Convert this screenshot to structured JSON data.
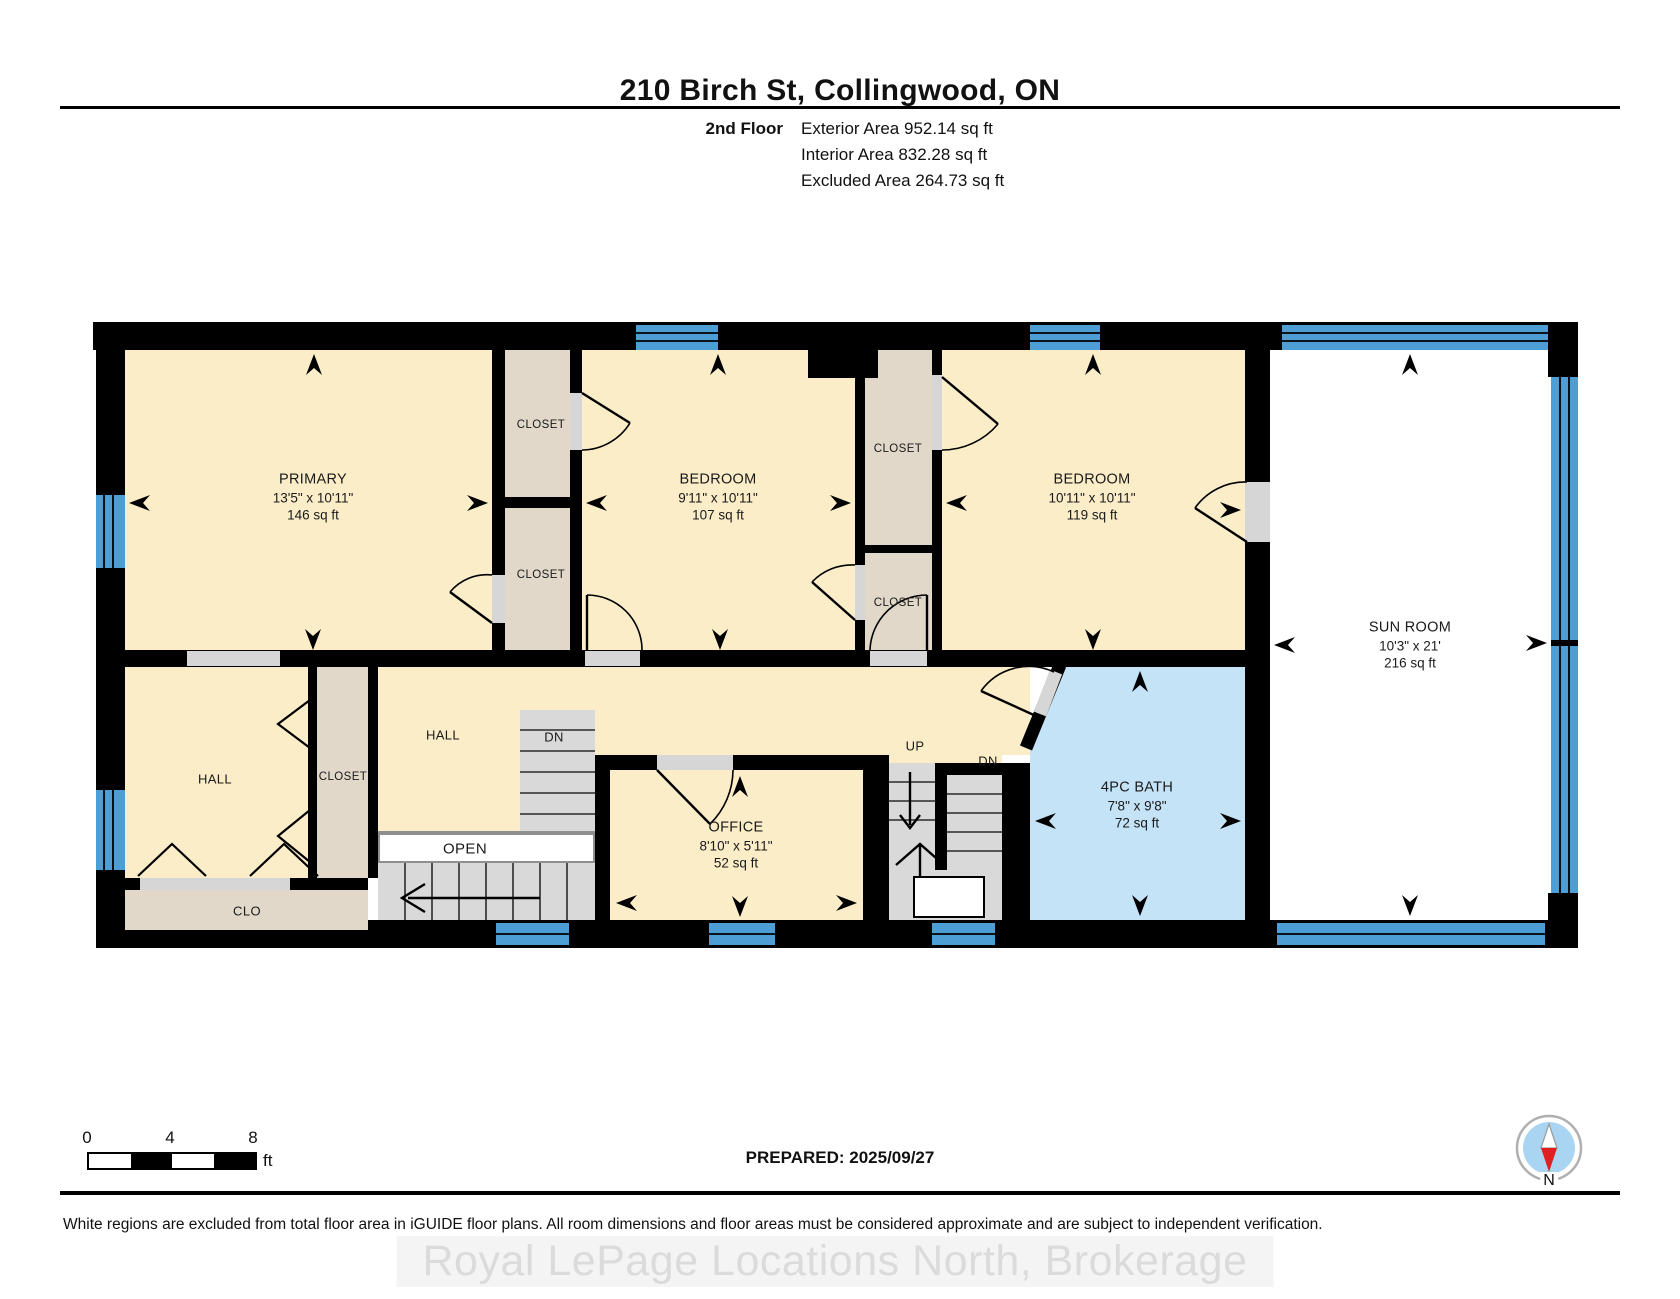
{
  "header": {
    "title": "210 Birch St, Collingwood, ON",
    "floor_label": "2nd Floor",
    "stats": [
      {
        "label": "Exterior Area",
        "value": "952.14 sq ft"
      },
      {
        "label": "Interior Area",
        "value": "832.28 sq ft"
      },
      {
        "label": "Excluded Area",
        "value": "264.73 sq ft"
      }
    ]
  },
  "plan": {
    "rooms": {
      "primary": {
        "name": "PRIMARY",
        "dims": "13'5\" x 10'11\"",
        "area": "146 sq ft"
      },
      "bedroom1": {
        "name": "BEDROOM",
        "dims": "9'11\" x 10'11\"",
        "area": "107 sq ft"
      },
      "bedroom2": {
        "name": "BEDROOM",
        "dims": "10'11\" x 10'11\"",
        "area": "119 sq ft"
      },
      "sunroom": {
        "name": "SUN ROOM",
        "dims": "10'3\" x 21'",
        "area": "216 sq ft"
      },
      "office": {
        "name": "OFFICE",
        "dims": "8'10\" x 5'11\"",
        "area": "52 sq ft"
      },
      "bath": {
        "name": "4PC BATH",
        "dims": "7'8\" x 9'8\"",
        "area": "72 sq ft"
      }
    },
    "labels": {
      "closet": "CLOSET",
      "hall": "HALL",
      "clo": "CLO",
      "open": "OPEN",
      "dn": "DN",
      "up": "UP"
    }
  },
  "scale": {
    "start": "0",
    "mid": "4",
    "end": "8",
    "unit": "ft"
  },
  "footer": {
    "prepared": "PREPARED: 2025/09/27",
    "compass_north": "N",
    "disclaimer": "White regions are excluded from total floor area in iGUIDE floor plans. All room dimensions and floor areas must be considered approximate and are subject to independent verification.",
    "watermark": "Royal LePage Locations North, Brokerage"
  },
  "colors": {
    "wall": "#000000",
    "room": "#FAEDC8",
    "closet": "#E1D8C9",
    "bath": "#C4E3F6",
    "window": "#4E9ED6",
    "excluded": "#FFFFFF",
    "stair": "#D9D9D9",
    "compass_face": "#A9D5F2",
    "compass_needle": "#E02020"
  }
}
